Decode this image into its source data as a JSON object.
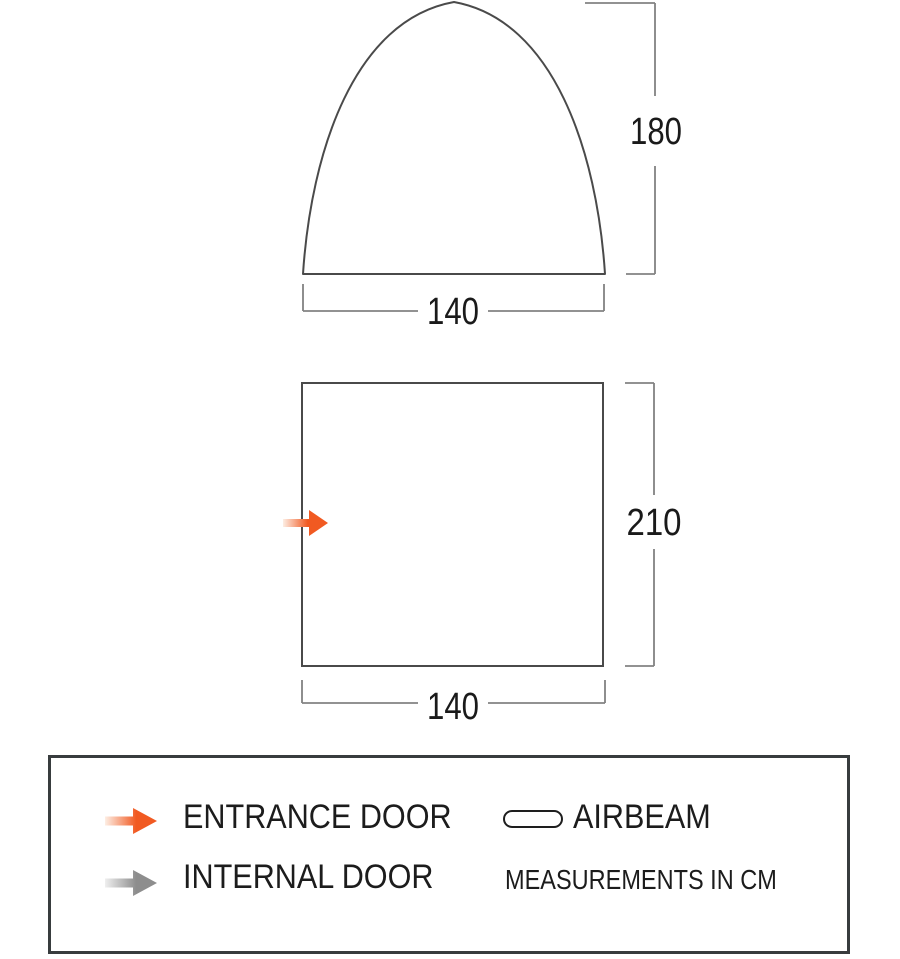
{
  "diagram": {
    "front_view": {
      "height_label": "180",
      "width_label": "140"
    },
    "floor_plan": {
      "depth_label": "210",
      "width_label": "140"
    }
  },
  "legend": {
    "entrance_door_label": "ENTRANCE DOOR",
    "internal_door_label": "INTERNAL DOOR",
    "airbeam_label": "AIRBEAM",
    "measurements_note": "MEASUREMENTS IN CM"
  },
  "icons": {
    "entrance_door": "orange-right-arrow-icon",
    "internal_door": "grey-right-arrow-icon",
    "airbeam": "pill-outline-icon"
  },
  "colors": {
    "entrance_orange": "#f15a22",
    "entrance_orange_pale": "#fdeee4",
    "internal_grey": "#8d8d8d",
    "internal_grey_pale": "#efefef",
    "outline_grey": "#4a4a4a",
    "dimension_grey": "#828282",
    "text": "#1a1a1a",
    "legend_border": "#383c3e",
    "background": "#ffffff"
  },
  "dimensions_cm": {
    "front_height": 180,
    "front_width": 140,
    "floor_depth": 210,
    "floor_width": 140
  }
}
